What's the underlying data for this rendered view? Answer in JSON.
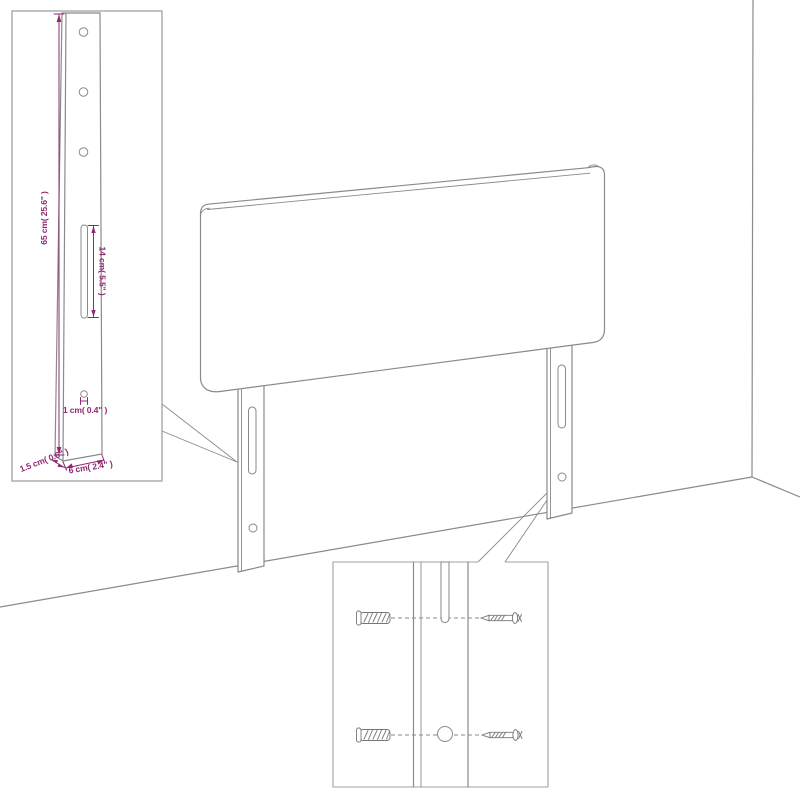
{
  "figure": {
    "type": "product-dimension-diagram",
    "subject": "upholstered headboard with two mounting legs shown against a room corner",
    "views": [
      "main-perspective-view",
      "leg-dimension-detail",
      "wall-mounting-hardware-detail"
    ]
  },
  "colors": {
    "line": "#8a8a8a",
    "line-light": "#a0a0a0",
    "dimension": "#8e2a72",
    "background": "#ffffff"
  },
  "insets": {
    "leg_detail": {
      "labels": {
        "height": "65 cm( 25.6\" )",
        "slot": "14 cm( 5.5\" )",
        "hole": "1 cm( 0.4\" )",
        "thickness": "1.5 cm( 0.6\" )",
        "width": "6 cm( 2.4\" )"
      }
    },
    "mounting_detail": {
      "icons": {
        "wall_plug": "wall-plug-icon",
        "screw": "screw-icon"
      }
    }
  }
}
